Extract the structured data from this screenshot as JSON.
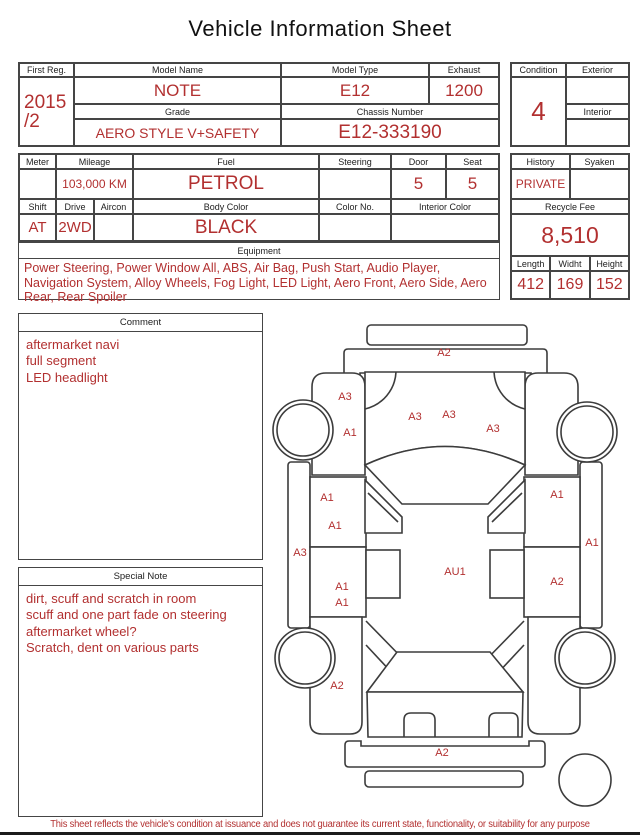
{
  "title": "Vehicle Information Sheet",
  "colors": {
    "accent_red": "#b23030",
    "border": "#454545",
    "diagram_line": "#3c3c3c"
  },
  "info1": {
    "first_reg_label": "First Reg.",
    "first_reg_line1": "2015",
    "first_reg_line2": "/2",
    "model_name_label": "Model Name",
    "model_name": "NOTE",
    "model_type_label": "Model Type",
    "model_type": "E12",
    "exhaust_label": "Exhaust",
    "exhaust": "1200",
    "grade_label": "Grade",
    "grade": "AERO STYLE V+SAFETY",
    "chassis_label": "Chassis Number",
    "chassis": "E12-333190",
    "condition_label": "Condition",
    "condition": "4",
    "exterior_label": "Exterior",
    "exterior": "",
    "interior_label": "Interior",
    "interior": ""
  },
  "info2": {
    "meter_label": "Meter",
    "meter": "",
    "mileage_label": "Mileage",
    "mileage": "103,000 KM",
    "fuel_label": "Fuel",
    "fuel": "PETROL",
    "steering_label": "Steering",
    "steering": "",
    "door_label": "Door",
    "door": "5",
    "seat_label": "Seat",
    "seat": "5",
    "shift_label": "Shift",
    "shift": "AT",
    "drive_label": "Drive",
    "drive": "2WD",
    "aircon_label": "Aircon",
    "aircon": "",
    "body_color_label": "Body Color",
    "body_color": "BLACK",
    "color_no_label": "Color No.",
    "color_no": "",
    "interior_color_label": "Interior Color",
    "interior_color": ""
  },
  "history_block": {
    "history_label": "History",
    "history": "PRIVATE",
    "syaken_label": "Syaken",
    "syaken": "",
    "recycle_label": "Recycle Fee",
    "recycle_fee": "8,510",
    "length_label": "Length",
    "length": "412",
    "width_label": "Widht",
    "width": "169",
    "height_label": "Height",
    "height": "152"
  },
  "equipment": {
    "label": "Equipment",
    "text": "Power Steering, Power Window All, ABS, Air Bag, Push Start, Audio Player, Navigation System, Alloy Wheels, Fog Light, LED Light, Aero Front, Aero Side, Aero Rear, Rear Spoiler"
  },
  "comment": {
    "label": "Comment",
    "lines": [
      "aftermarket navi",
      "full segment",
      "LED headlight"
    ]
  },
  "special_note": {
    "label": "Special Note",
    "lines": [
      "dirt, scuff and scratch in room",
      "scuff and one part fade on steering",
      "aftermarket wheel?",
      "Scratch, dent on various parts"
    ]
  },
  "diagram": {
    "marks": [
      {
        "code": "A2",
        "x": 172,
        "y": 38
      },
      {
        "code": "A3",
        "x": 73,
        "y": 82
      },
      {
        "code": "A1",
        "x": 78,
        "y": 118
      },
      {
        "code": "A3",
        "x": 143,
        "y": 102
      },
      {
        "code": "A3",
        "x": 177,
        "y": 100
      },
      {
        "code": "A3",
        "x": 221,
        "y": 114
      },
      {
        "code": "A1",
        "x": 55,
        "y": 183
      },
      {
        "code": "A1",
        "x": 63,
        "y": 211
      },
      {
        "code": "A3",
        "x": 28,
        "y": 238
      },
      {
        "code": "A1",
        "x": 70,
        "y": 272
      },
      {
        "code": "A1",
        "x": 70,
        "y": 288
      },
      {
        "code": "AU1",
        "x": 183,
        "y": 257
      },
      {
        "code": "A1",
        "x": 285,
        "y": 180
      },
      {
        "code": "A1",
        "x": 320,
        "y": 228
      },
      {
        "code": "A2",
        "x": 285,
        "y": 267
      },
      {
        "code": "A2",
        "x": 65,
        "y": 371
      },
      {
        "code": "A2",
        "x": 170,
        "y": 438
      }
    ]
  },
  "footer": "This sheet reflects the vehicle's condition at issuance and does not guarantee its current state, functionality, or suitability for any purpose"
}
